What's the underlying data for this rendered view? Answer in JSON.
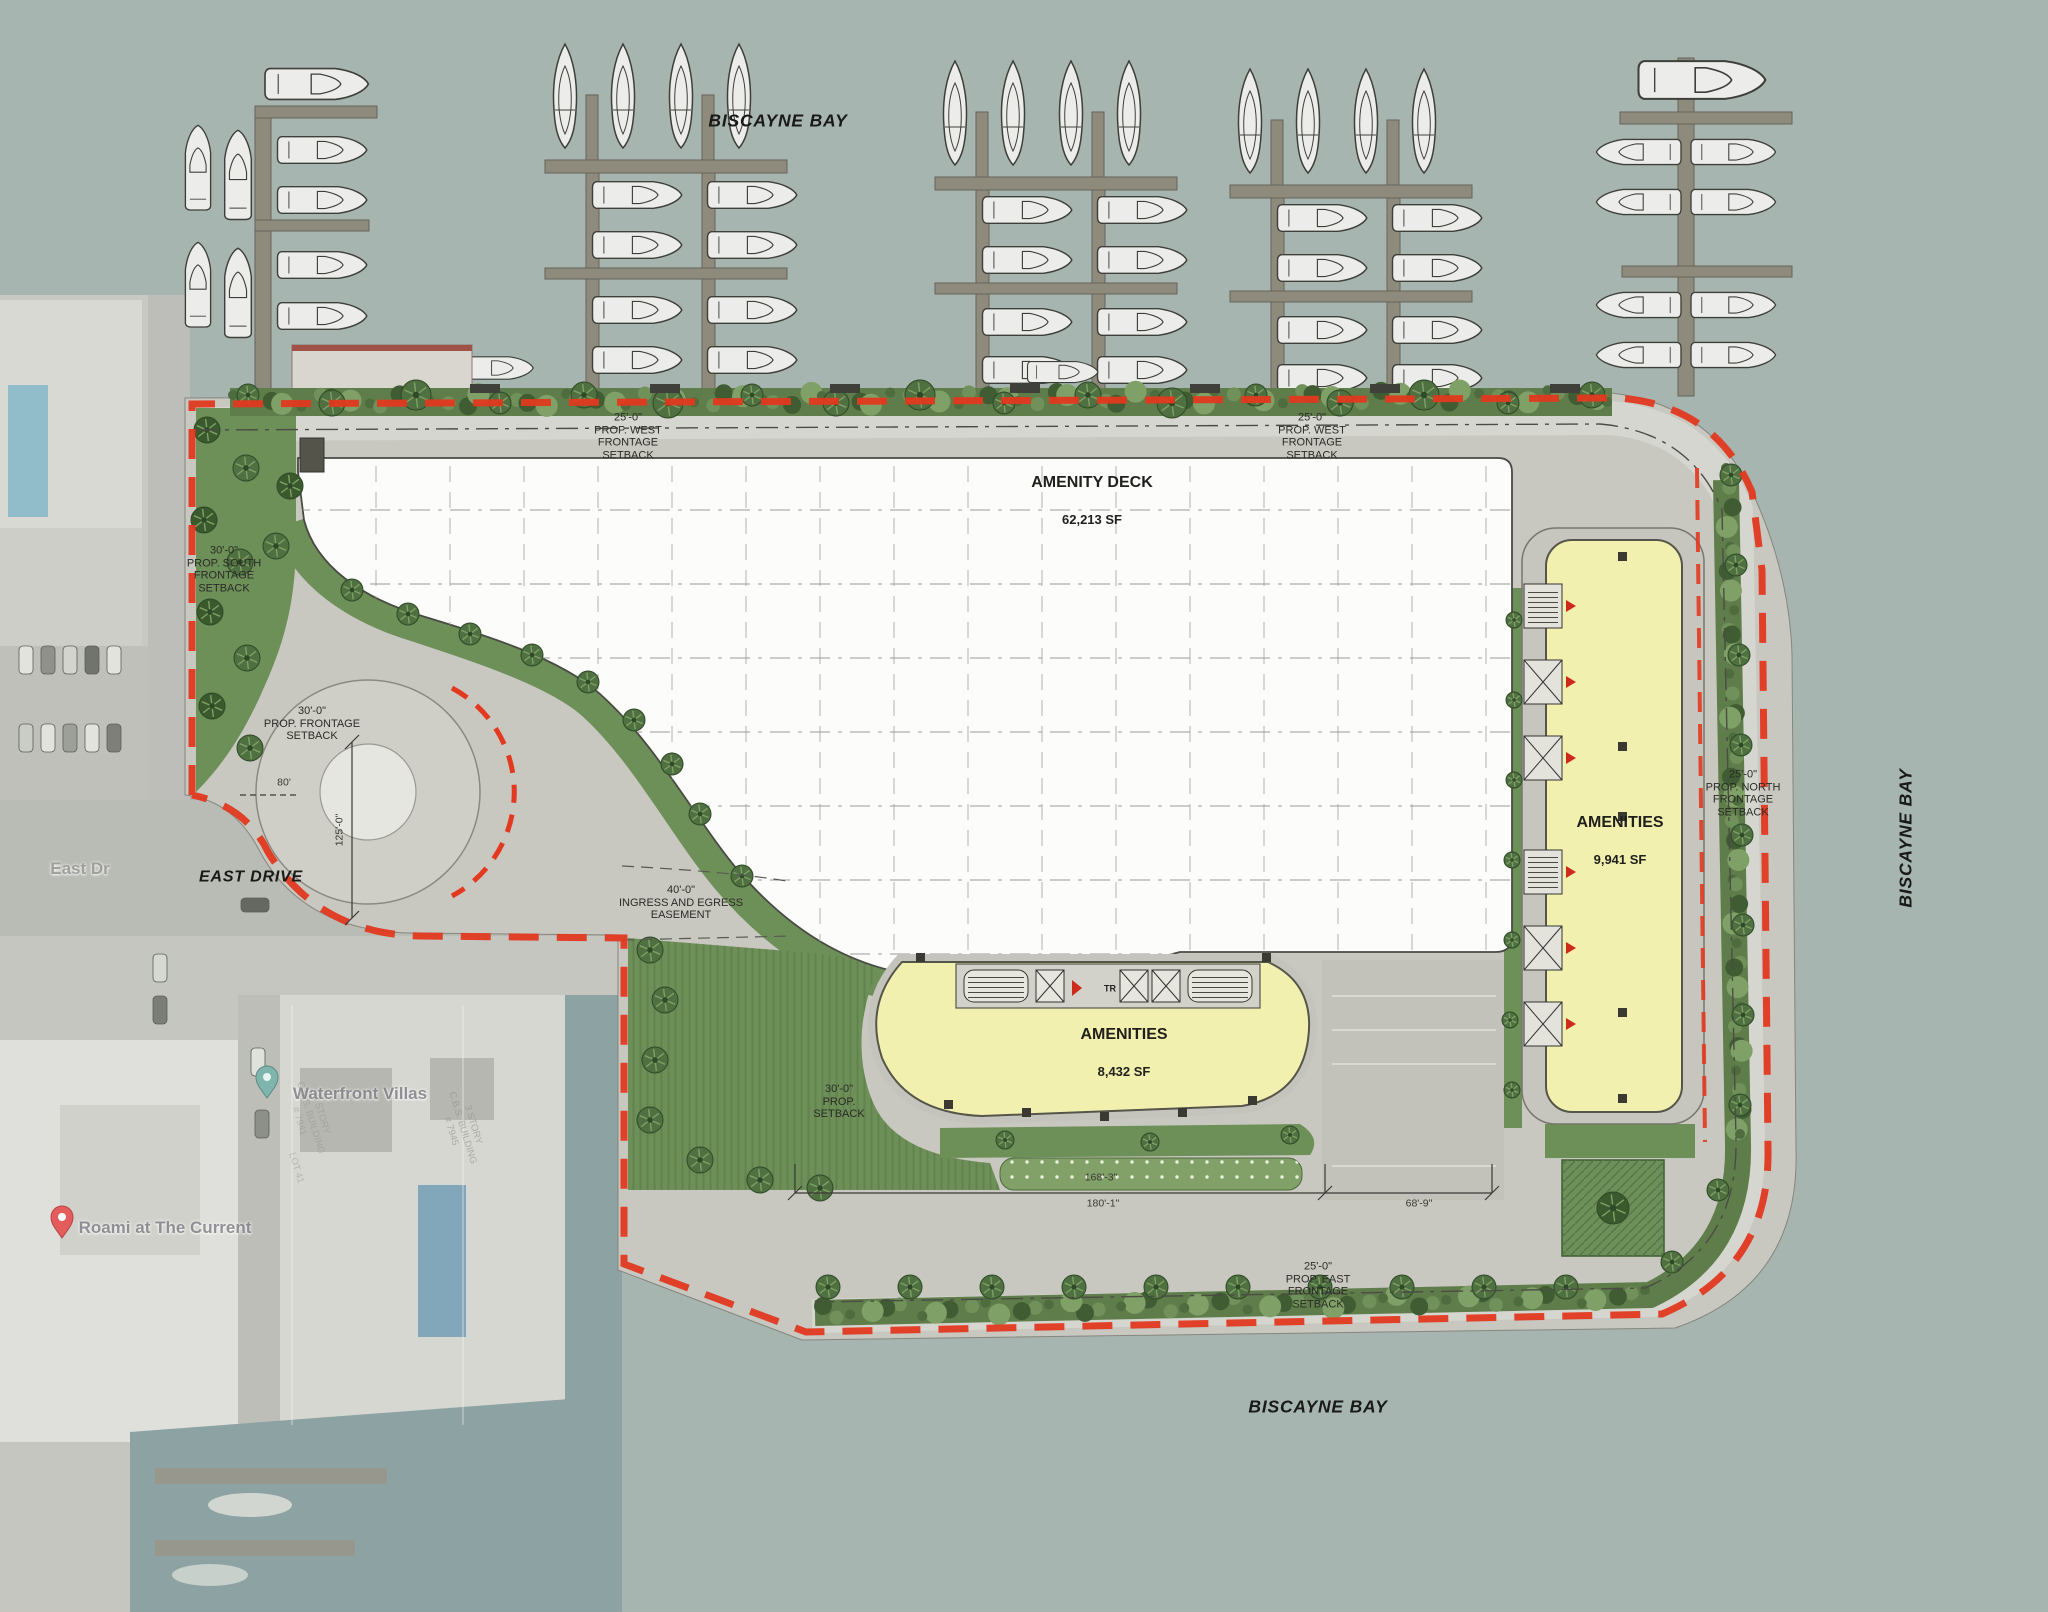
{
  "water_labels": {
    "bay_top": "BISCAYNE BAY",
    "bay_right": "BISCAYNE BAY",
    "bay_bottom": "BISCAYNE BAY"
  },
  "areas": {
    "amenity_deck": {
      "name": "AMENITY DECK",
      "sf": "62,213 SF"
    },
    "amenities_center": {
      "name": "AMENITIES",
      "sf": "8,432 SF"
    },
    "amenities_east": {
      "name": "AMENITIES",
      "sf": "9,941 SF"
    }
  },
  "setbacks": {
    "west": "25'-0\"\nPROP. WEST\nFRONTAGE\nSETBACK",
    "south": "30'-0\"\nPROP. SOUTH\nFRONTAGE\nSETBACK",
    "frontage": "30'-0\"\nPROP. FRONTAGE\nSETBACK",
    "prop": "30'-0\"\nPROP.\nSETBACK",
    "north": "25'-0\"\nPROP. NORTH\nFRONTAGE\nSETBACK",
    "east": "25'-0\"\nPROP. EAST\nFRONTAGE\nSETBACK",
    "ingress": "40'-0\"\nINGRESS AND EGRESS\nEASEMENT"
  },
  "dimensions": {
    "d168": "168'-3\"",
    "d180": "180'-1\"",
    "d68": "68'-9\"",
    "d80": "80'",
    "d125": "125'-0\""
  },
  "streets": {
    "east_drive": "EAST DRIVE",
    "east_dr_map": "East Dr"
  },
  "map_pois": {
    "waterfront_villas": "Waterfront Villas",
    "roami": "Roami at The Current"
  },
  "survey_notes": {
    "bldg_7945": "3 STORY\nC.B.S. BUILDING\n# 7945",
    "bldg_7941": "3 STORY\nC.B.S. BUILDING\n# 7941",
    "lot41": "LOT 41",
    "tr": "TR"
  },
  "colors": {
    "water": "#a6b5b0",
    "property_line": "#e2391f",
    "deck_white": "#fcfcfa",
    "building_yellow": "#f2f0ae",
    "landscape_green": "#6d8f58",
    "paving": "#c8c8c1",
    "dock": "#8e8b7d"
  }
}
